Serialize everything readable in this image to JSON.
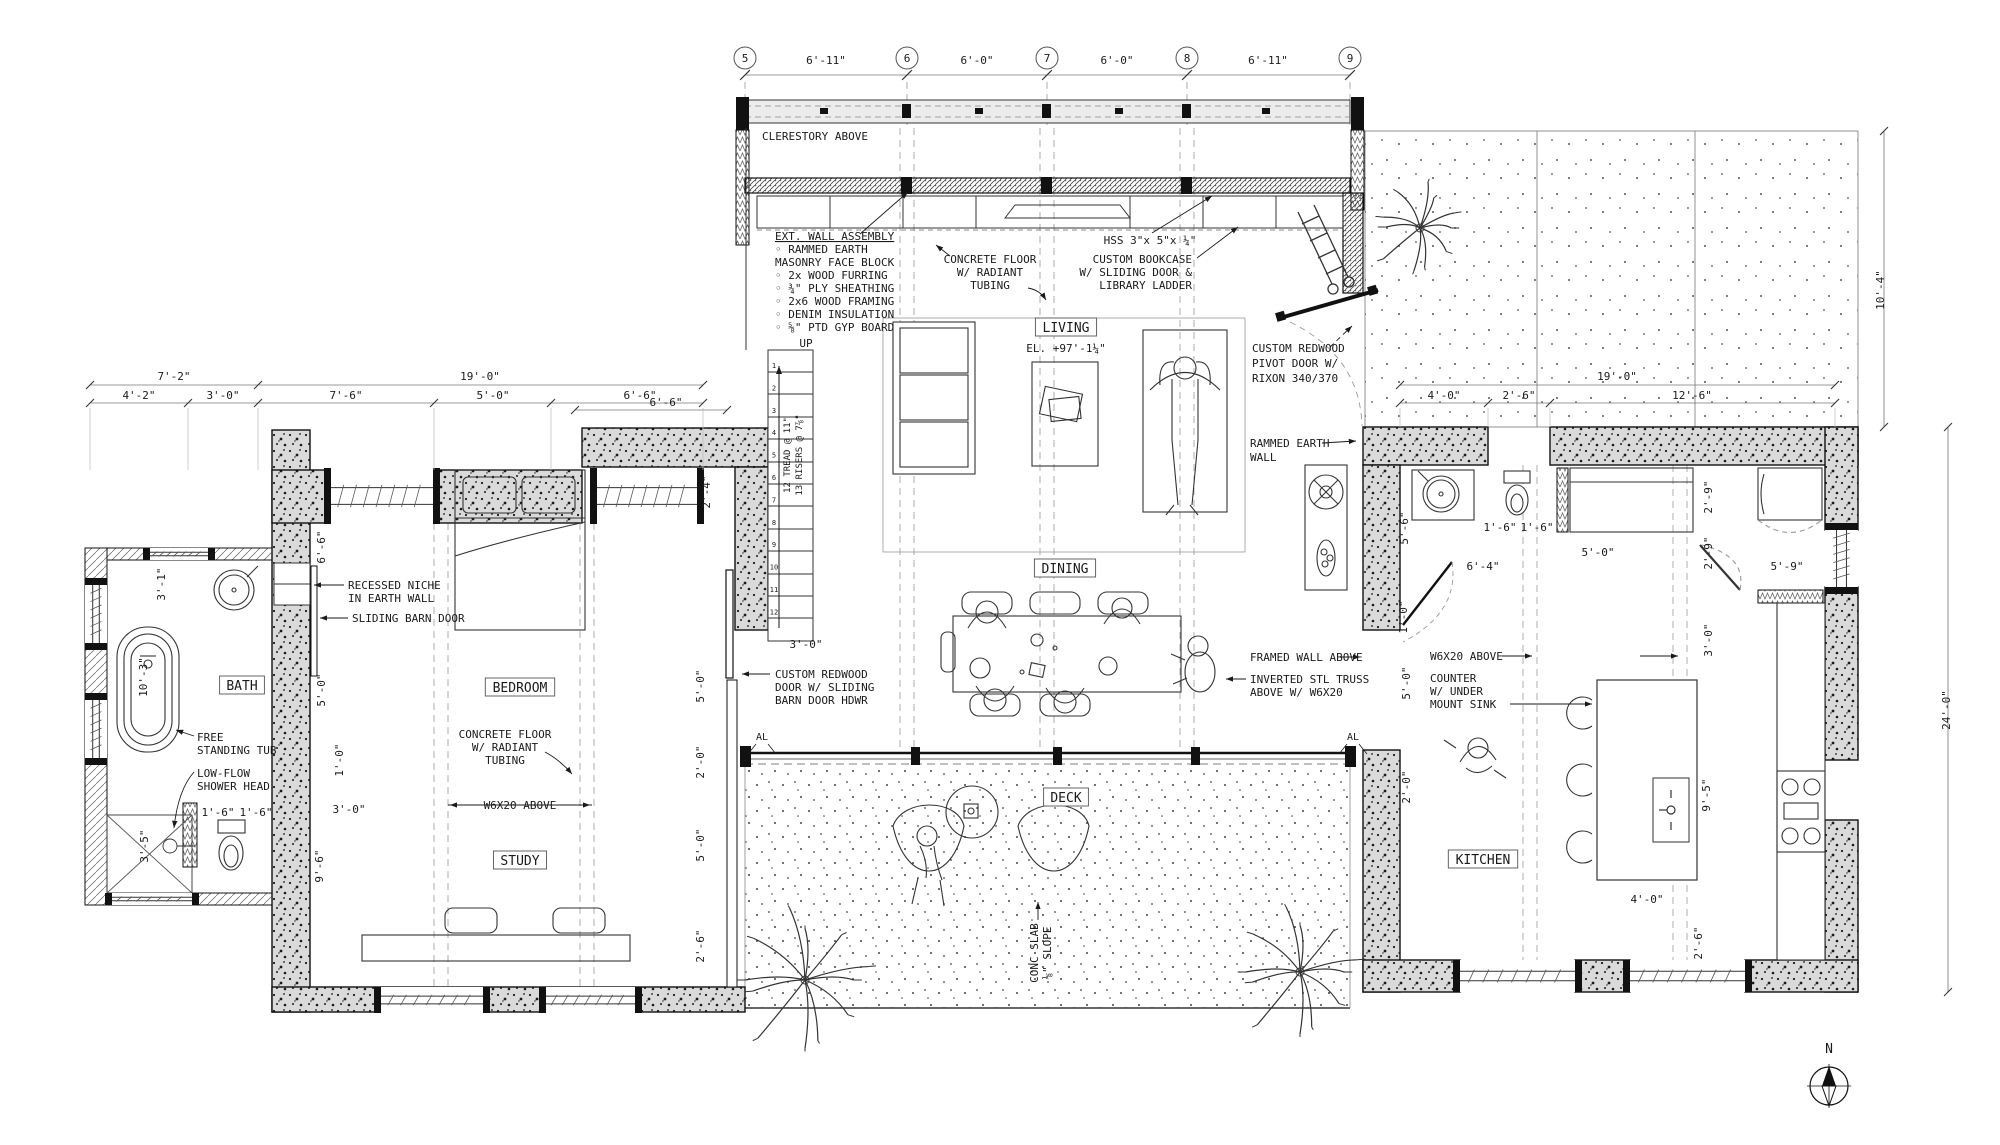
{
  "drawing_type": "residential floor plan",
  "colors": {
    "line": "#1a1a1a",
    "wall_fill": "#dadada",
    "paper": "#ffffff",
    "dash": "#888888"
  },
  "grid": {
    "bubbles": [
      {
        "label": "5",
        "x": 745
      },
      {
        "label": "6",
        "x": 907
      },
      {
        "label": "7",
        "x": 1047
      },
      {
        "label": "8",
        "x": 1187
      },
      {
        "label": "9",
        "x": 1350
      }
    ],
    "dims": [
      {
        "text": "6'-11\"",
        "x": 826
      },
      {
        "text": "6'-0\"",
        "x": 977
      },
      {
        "text": "6'-0\"",
        "x": 1117
      },
      {
        "text": "6'-11\"",
        "x": 1268
      }
    ]
  },
  "rooms": [
    {
      "name": "living",
      "label": "LIVING",
      "x": 1066,
      "y": 330
    },
    {
      "name": "dining",
      "label": "DINING",
      "x": 1065,
      "y": 571
    },
    {
      "name": "deck",
      "label": "DECK",
      "x": 1066,
      "y": 800
    },
    {
      "name": "bedroom",
      "label": "BEDROOM",
      "x": 520,
      "y": 690
    },
    {
      "name": "bath",
      "label": "BATH",
      "x": 242,
      "y": 688
    },
    {
      "name": "study",
      "label": "STUDY",
      "x": 520,
      "y": 863
    },
    {
      "name": "kitchen",
      "label": "KITCHEN",
      "x": 1483,
      "y": 862
    }
  ],
  "annotations": [
    {
      "name": "clerestory-above",
      "lines": [
        "CLERESTORY ABOVE"
      ],
      "x": 762,
      "y": 140,
      "anchor": "start"
    },
    {
      "name": "ext-wall-assembly",
      "lines": [
        "EXT. WALL ASSEMBLY",
        "◦ RAMMED EARTH",
        "   MASONRY FACE BLOCK",
        "◦ 2x WOOD FURRING",
        "◦ ¾\" PLY SHEATHING",
        "◦ 2x6 WOOD FRAMING",
        "◦ DENIM INSULATION",
        "◦ ⅝\" PTD GYP BOARD"
      ],
      "x": 775,
      "y": 240,
      "anchor": "start",
      "lh": 13,
      "underline_first": true
    },
    {
      "name": "up-label",
      "lines": [
        "UP"
      ],
      "x": 806,
      "y": 347,
      "anchor": "middle"
    },
    {
      "name": "stair-treads-note",
      "lines": [
        "12 TREAD @ 11\""
      ],
      "x": 790,
      "y": 455,
      "anchor": "middle",
      "rot": true,
      "size": 9
    },
    {
      "name": "stair-risers-note",
      "lines": [
        "13 RISERS @ 7⅞\""
      ],
      "x": 802,
      "y": 455,
      "anchor": "middle",
      "rot": true,
      "size": 9
    },
    {
      "name": "concrete-floor-living",
      "lines": [
        "CONCRETE FLOOR",
        "W/ RADIANT",
        "TUBING"
      ],
      "x": 990,
      "y": 263,
      "anchor": "middle"
    },
    {
      "name": "hss-note",
      "lines": [
        "HSS 3\"x 5\"x ¼\""
      ],
      "x": 1150,
      "y": 244,
      "anchor": "middle"
    },
    {
      "name": "custom-bookcase-note",
      "lines": [
        "CUSTOM BOOKCASE",
        "W/ SLIDING DOOR &",
        "LIBRARY LADDER"
      ],
      "x": 1192,
      "y": 263,
      "anchor": "end"
    },
    {
      "name": "pivot-door-note",
      "lines": [
        "CUSTOM REDWOOD",
        "PIVOT DOOR W/",
        "RIXON 340/370"
      ],
      "x": 1252,
      "y": 352,
      "anchor": "start",
      "lh": 15
    },
    {
      "name": "rammed-earth-wall-note",
      "lines": [
        "RAMMED EARTH",
        "WALL"
      ],
      "x": 1250,
      "y": 447,
      "anchor": "start",
      "lh": 14
    },
    {
      "name": "living-elevation",
      "lines": [
        "EL. +97'-1¼\""
      ],
      "x": 1066,
      "y": 352,
      "anchor": "middle"
    },
    {
      "name": "recessed-niche-note",
      "lines": [
        "RECESSED NICHE",
        "IN EARTH WALL"
      ],
      "x": 348,
      "y": 589,
      "anchor": "start"
    },
    {
      "name": "sliding-barn-door-note",
      "lines": [
        "SLIDING BARN DOOR"
      ],
      "x": 352,
      "y": 622,
      "anchor": "start"
    },
    {
      "name": "free-standing-tub-note",
      "lines": [
        "FREE",
        "STANDING TUB"
      ],
      "x": 197,
      "y": 741,
      "anchor": "start"
    },
    {
      "name": "low-flow-note",
      "lines": [
        "LOW-FLOW",
        "SHOWER HEAD"
      ],
      "x": 197,
      "y": 777,
      "anchor": "start"
    },
    {
      "name": "concrete-floor-study",
      "lines": [
        "CONCRETE FLOOR",
        "W/ RADIANT",
        "TUBING"
      ],
      "x": 505,
      "y": 738,
      "anchor": "middle"
    },
    {
      "name": "w6x20-study",
      "lines": [
        "W6X20 ABOVE"
      ],
      "x": 520,
      "y": 809,
      "anchor": "middle"
    },
    {
      "name": "custom-redwood-door-note",
      "lines": [
        "CUSTOM REDWOOD",
        "DOOR W/ SLIDING",
        "BARN DOOR HDWR"
      ],
      "x": 775,
      "y": 678,
      "anchor": "start"
    },
    {
      "name": "framed-wall-above-note",
      "lines": [
        "FRAMED WALL ABOVE"
      ],
      "x": 1250,
      "y": 661,
      "anchor": "start"
    },
    {
      "name": "inverted-truss-note",
      "lines": [
        "INVERTED STL TRUSS",
        "ABOVE W/ W6X20"
      ],
      "x": 1250,
      "y": 683,
      "anchor": "start"
    },
    {
      "name": "w6x20-kitchen",
      "lines": [
        "W6X20 ABOVE"
      ],
      "x": 1430,
      "y": 660,
      "anchor": "start"
    },
    {
      "name": "counter-note",
      "lines": [
        "COUNTER",
        "W/ UNDER",
        "MOUNT SINK"
      ],
      "x": 1430,
      "y": 682,
      "anchor": "start"
    },
    {
      "name": "conc-slab-note",
      "lines": [
        "CONC SLAB",
        "⅛\" SLOPE"
      ],
      "x": 1038,
      "y": 953,
      "anchor": "middle",
      "rot": true,
      "lh": 13
    },
    {
      "name": "al-left",
      "lines": [
        "AL"
      ],
      "x": 762,
      "y": 740,
      "anchor": "middle",
      "size": 10
    },
    {
      "name": "al-right",
      "lines": [
        "AL"
      ],
      "x": 1353,
      "y": 740,
      "anchor": "middle",
      "size": 10
    }
  ],
  "dimensions": [
    {
      "name": "dim-left-bath-total",
      "text": "7'-2\"",
      "x": 174,
      "y": 380
    },
    {
      "name": "dim-left-wing-total",
      "text": "19'-0\"",
      "x": 480,
      "y": 380
    },
    {
      "name": "dim-left-1",
      "text": "4'-2\"",
      "x": 139,
      "y": 399
    },
    {
      "name": "dim-left-2",
      "text": "3'-0\"",
      "x": 223,
      "y": 399
    },
    {
      "name": "dim-left-3",
      "text": "7'-6\"",
      "x": 346,
      "y": 399
    },
    {
      "name": "dim-left-4",
      "text": "5'-0\"",
      "x": 493,
      "y": 399
    },
    {
      "name": "dim-left-5",
      "text": "6'-6\"",
      "x": 640,
      "y": 399
    },
    {
      "name": "dim-right-total",
      "text": "19'-0\"",
      "x": 1617,
      "y": 380
    },
    {
      "name": "dim-right-1",
      "text": "4'-0\"",
      "x": 1444,
      "y": 399
    },
    {
      "name": "dim-right-2",
      "text": "2'-6\"",
      "x": 1519,
      "y": 399
    },
    {
      "name": "dim-right-3",
      "text": "12'-6\"",
      "x": 1692,
      "y": 399
    },
    {
      "name": "dim-patio-height",
      "text": "10'-4\"",
      "x": 1884,
      "y": 290,
      "rot": true
    },
    {
      "name": "dim-kitchen-wing-height",
      "text": "24'-0\"",
      "x": 1950,
      "y": 710,
      "rot": true
    },
    {
      "name": "dim-closet",
      "text": "6'-6\"",
      "x": 325,
      "y": 547,
      "rot": true
    },
    {
      "name": "dim-bath-vanity",
      "text": "3'-1\"",
      "x": 165,
      "y": 584,
      "rot": true
    },
    {
      "name": "dim-stair-window",
      "text": "2'-4\"",
      "x": 710,
      "y": 492,
      "rot": true
    },
    {
      "name": "dim-tub",
      "text": "10'-3\"",
      "x": 147,
      "y": 677,
      "rot": true
    },
    {
      "name": "dim-bath-door",
      "text": "5'-0\"",
      "x": 325,
      "y": 690,
      "rot": true
    },
    {
      "name": "dim-bath-wall",
      "text": "1'-0\"",
      "x": 343,
      "y": 760,
      "rot": true
    },
    {
      "name": "dim-study-door",
      "text": "3'-0\"",
      "x": 349,
      "y": 813
    },
    {
      "name": "dim-shower",
      "text": "3'-5\"",
      "x": 148,
      "y": 846,
      "rot": true
    },
    {
      "name": "dim-wc-1",
      "text": "1'-6\"",
      "x": 218,
      "y": 816
    },
    {
      "name": "dim-wc-2",
      "text": "1'-6\"",
      "x": 256,
      "y": 816
    },
    {
      "name": "dim-study-wall",
      "text": "9'-6\"",
      "x": 323,
      "y": 866,
      "rot": true
    },
    {
      "name": "dim-bedroom-east-1",
      "text": "5'-0\"",
      "x": 704,
      "y": 686,
      "rot": true
    },
    {
      "name": "dim-bedroom-east-2",
      "text": "2'-0\"",
      "x": 704,
      "y": 762,
      "rot": true
    },
    {
      "name": "dim-bedroom-east-3",
      "text": "5'-0\"",
      "x": 704,
      "y": 845,
      "rot": true
    },
    {
      "name": "dim-bedroom-east-4",
      "text": "2'-6\"",
      "x": 704,
      "y": 946,
      "rot": true
    },
    {
      "name": "dim-entry",
      "text": "6'-6\"",
      "x": 666,
      "y": 406
    },
    {
      "name": "dim-stair-door",
      "text": "3'-0\"",
      "x": 806,
      "y": 648
    },
    {
      "name": "dim-powder-depth",
      "text": "5'-6\"",
      "x": 1408,
      "y": 528,
      "rot": true
    },
    {
      "name": "dim-kitchen-door",
      "text": "6'-4\"",
      "x": 1483,
      "y": 570
    },
    {
      "name": "dim-powder-wc-1",
      "text": "1'-6\"",
      "x": 1500,
      "y": 531
    },
    {
      "name": "dim-powder-wc-2",
      "text": "1'-6\"",
      "x": 1537,
      "y": 531
    },
    {
      "name": "dim-closet-width",
      "text": "5'-0\"",
      "x": 1598,
      "y": 556
    },
    {
      "name": "dim-pantry-1",
      "text": "2'-9\"",
      "x": 1712,
      "y": 497,
      "rot": true
    },
    {
      "name": "dim-pantry-2",
      "text": "2'-9\"",
      "x": 1712,
      "y": 553,
      "rot": true
    },
    {
      "name": "dim-kitchen-window",
      "text": "5'-9\"",
      "x": 1787,
      "y": 570
    },
    {
      "name": "dim-island-clear",
      "text": "3'-0\"",
      "x": 1712,
      "y": 640,
      "rot": true
    },
    {
      "name": "dim-kitchen-west-1",
      "text": "1'-0\"",
      "x": 1407,
      "y": 617,
      "rot": true
    },
    {
      "name": "dim-kitchen-west-2",
      "text": "5'-0\"",
      "x": 1410,
      "y": 683,
      "rot": true
    },
    {
      "name": "dim-kitchen-west-3",
      "text": "2'-0\"",
      "x": 1410,
      "y": 787,
      "rot": true
    },
    {
      "name": "dim-island-length",
      "text": "9'-5\"",
      "x": 1710,
      "y": 795,
      "rot": true
    },
    {
      "name": "dim-island-width",
      "text": "4'-0\"",
      "x": 1647,
      "y": 903
    },
    {
      "name": "dim-island-end",
      "text": "2'-6\"",
      "x": 1702,
      "y": 943,
      "rot": true
    }
  ],
  "stair": {
    "numbers": [
      "1",
      "2",
      "3",
      "4",
      "5",
      "6",
      "7",
      "8",
      "9",
      "10",
      "11",
      "12"
    ]
  },
  "compass": {
    "label": "N"
  }
}
